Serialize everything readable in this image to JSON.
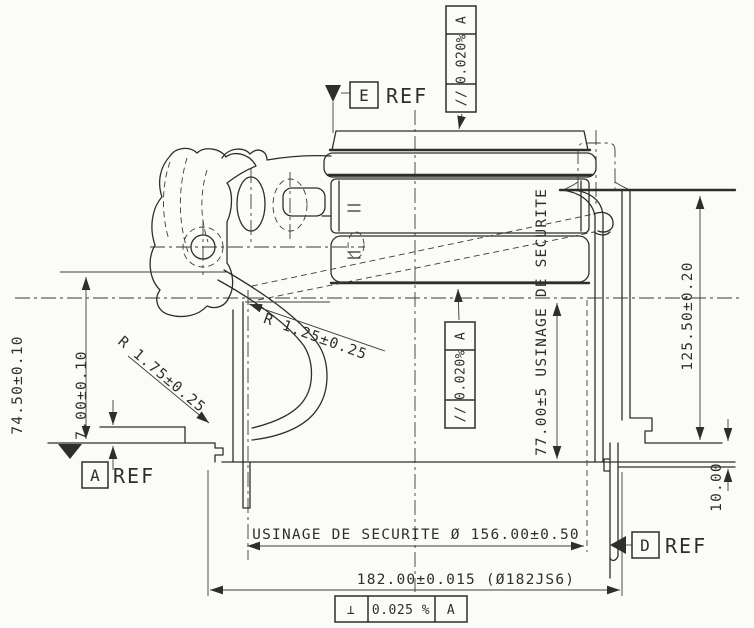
{
  "drawing": {
    "datum_e": {
      "letter": "E",
      "ref": "REF"
    },
    "datum_a": {
      "letter": "A",
      "ref": "REF"
    },
    "datum_d": {
      "letter": "D",
      "ref": "REF"
    },
    "fcf_top": {
      "symbol": "//",
      "value": "0.020%",
      "datum": "A"
    },
    "fcf_middle": {
      "symbol": "//",
      "value": "0.020%",
      "datum": "A"
    },
    "fcf_bottom": {
      "symbol": "⊥",
      "value": "0.025 %",
      "datum": "A"
    },
    "dim_left_height": "74.50±0.10",
    "dim_left_step": "7.00±0.10",
    "dim_radius_large": "R 1.75±0.25",
    "dim_radius_small": "R 1.25±0.25",
    "dim_right_height": "125.50±0.20",
    "dim_right_rim": "10.00",
    "dim_safety_depth": "77.00±5 USINAGE DE SECURITE",
    "dim_safety_bore": "USINAGE DE SECURITE Ø 156.00±0.50",
    "dim_outer_diameter": "182.00±0.015 (Ø182JS6)"
  }
}
